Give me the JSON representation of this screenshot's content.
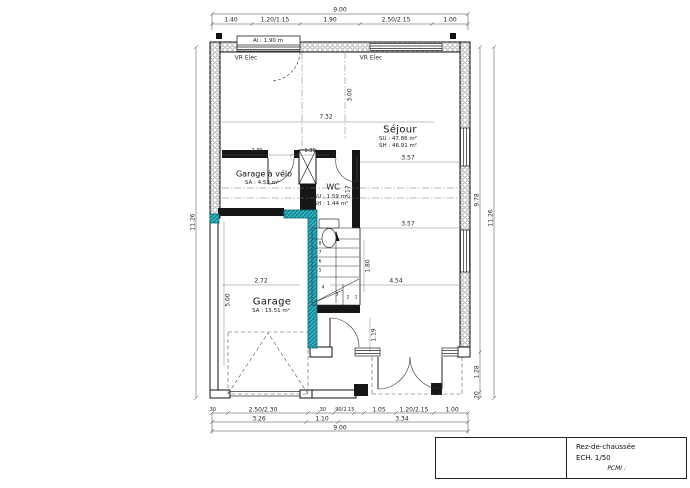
{
  "title_block": {
    "floor": "Rez-de-chaussée",
    "scale": "ECH. 1/50",
    "pcmi": "PCMI :"
  },
  "rooms": {
    "sejour": {
      "name": "Séjour",
      "su": "SU : 47.86 m²",
      "sh": "SH : 46.91 m²"
    },
    "garage_velo": {
      "name": "Garage à vélo",
      "sa": "SA : 4.53 m²"
    },
    "wc": {
      "name": "WC",
      "su": "SU : 1.59 m²",
      "sh": "SH : 1.44 m²"
    },
    "garage": {
      "name": "Garage",
      "sa": "SA : 15.51 m²"
    }
  },
  "annotations": {
    "vr_elec_left": "VR Elec",
    "vr_elec_right": "VR Elec",
    "window_sill": "Al : 1.90 m"
  },
  "dims": {
    "top_total": "9.00",
    "top_segments": [
      "1.40",
      "1.20/1.15",
      "1.90",
      "2.50/2.15",
      "1.00"
    ],
    "left_total": "11.26",
    "right": {
      "inner": "9.78",
      "outer": "11.26",
      "lower": "1.28",
      "bottom": ".20"
    },
    "bottom_row1": [
      ".30",
      "2.50/2.30",
      ".30",
      ".90/2.15",
      "1.05",
      "1.20/2.15",
      "1.00"
    ],
    "bottom_row2": [
      "3.26",
      "1.10",
      "3.34"
    ],
    "bottom_total": "9.00",
    "interior": {
      "living_width": "7.32",
      "entry_height": "3.00",
      "velo_width": "2.39",
      "wc_width": "1.31",
      "right_upper": "3.57",
      "right_lower": "3.57",
      "wc_height": "2.17",
      "stair_height": "1.80",
      "garage_width": "2.72",
      "sejour_width": "4.54",
      "door_height": "1.19",
      "garage_depth": "5.00"
    }
  },
  "stairs": {
    "steps": [
      "1",
      "2",
      "3",
      "4",
      "5",
      "6",
      "7",
      "8"
    ]
  },
  "colors": {
    "highlight_wall": "#2fb0bf",
    "wall_line": "#111111",
    "dim_line": "#444444"
  }
}
